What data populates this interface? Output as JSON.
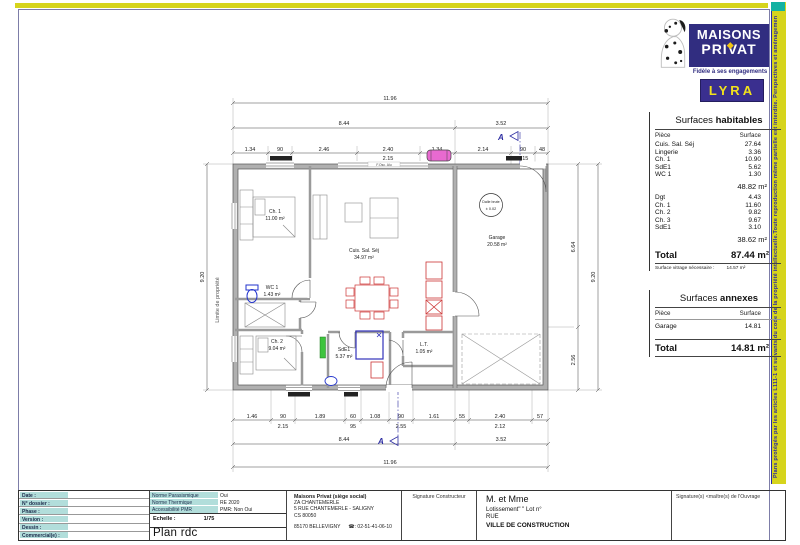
{
  "strips": {
    "copyright_vertical": "Plans protégés par les articles L111-1 et suivants du code de la propriété intellectuelle.Toute reproduction même partielle est interdite. Perspectives et aménagements extérieurs sont non contractuels"
  },
  "logo": {
    "brand_line1": "MAISONS",
    "brand_line2": "PRIVAT",
    "tagline": "Fidèle à ses engagements",
    "model": "LYRA"
  },
  "surfaces_habitables": {
    "title_normal": "Surfaces ",
    "title_bold": "habitables",
    "col_piece": "Pièce",
    "col_surface": "Surface",
    "group1": [
      {
        "n": "Cuis. Sal. Séj",
        "v": "27.64"
      },
      {
        "n": "Lingerie",
        "v": "3.36"
      },
      {
        "n": "Ch. 1",
        "v": "10.90"
      },
      {
        "n": "SdE1",
        "v": "5.62"
      },
      {
        "n": "WC 1",
        "v": "1.30"
      }
    ],
    "group1_subtotal": "48.82 m²",
    "group2": [
      {
        "n": "Dgt",
        "v": "4.43"
      },
      {
        "n": "Ch. 1",
        "v": "11.60"
      },
      {
        "n": "Ch. 2",
        "v": "9.82"
      },
      {
        "n": "Ch. 3",
        "v": "9.67"
      },
      {
        "n": "SdE1",
        "v": "3.10"
      }
    ],
    "group2_subtotal": "38.62 m²",
    "total_label": "Total",
    "total_value": "87.44 m²",
    "vitrage_label": "Surface vitrage nécessaire :",
    "vitrage_value": "14.57 m²"
  },
  "surfaces_annexes": {
    "title_normal": "Surfaces ",
    "title_bold": "annexes",
    "col_piece": "Pièce",
    "col_surface": "Surface",
    "rows": [
      {
        "n": "Garage",
        "v": "14.81"
      }
    ],
    "total_label": "Total",
    "total_value": "14.81 m²"
  },
  "plan": {
    "rooms": {
      "ch1": {
        "name": "Ch. 1",
        "area": "11.00 m²"
      },
      "wc1": {
        "name": "WC 1",
        "area": "1.43 m²"
      },
      "ch2": {
        "name": "Ch. 2",
        "area": "9.04 m²"
      },
      "sde1": {
        "name": "SdE1",
        "area": "5.37 m²"
      },
      "living": {
        "name": "Cuis. Sal. Séj",
        "area": "34.97 m²"
      },
      "lt": {
        "name": "L.T.",
        "area": "1.05 m²"
      },
      "garage": {
        "name": "Garage",
        "area": "20.58 m²"
      }
    },
    "level_marker": {
      "line1": "Dalle brute",
      "line2": "± 0.02"
    },
    "boundary_label": "Limite de propriété",
    "section_marker": "A",
    "window_label": "F.Osc. Alu",
    "dims": {
      "width_total": "11.96",
      "width_main": "8.44",
      "width_garage": "3.52",
      "top_row": [
        "1.34",
        "90",
        "2.46",
        "2.40",
        "1.34",
        "2.14",
        "90",
        "48"
      ],
      "top_row_sub": [
        "1.45",
        "2.15",
        "2.15"
      ],
      "bottom_row": [
        "1.46",
        "90",
        "1.89",
        "60",
        "1.08",
        "90",
        "1.61",
        "55",
        "2.40",
        "57"
      ],
      "bottom_row_sub": [
        "2.15",
        "95",
        "2.55",
        "2.12"
      ],
      "height_total": "9.20",
      "height_garage": "6.64",
      "height_terrace": "2.56",
      "interior": [
        "2.90",
        "4.79",
        "3.10",
        "4.79"
      ]
    }
  },
  "titleblock": {
    "left_fields": [
      "Date :",
      "N° dossier :",
      "Phase :",
      "Version :",
      "Dessin :",
      "Commercial(e) :"
    ],
    "norms": [
      {
        "label": "Norme Parasismique",
        "value": "Oui"
      },
      {
        "label": "Norme Thermique",
        "value": "RE 2020"
      },
      {
        "label": "Accessibilité PMR",
        "value": "PMR: Non Oui"
      }
    ],
    "scale_label": "Echelle :",
    "scale_value": "1/75",
    "plan_name": "Plan rdc",
    "company_name": "Maisons Privat (siège social)",
    "company_addr1": "ZA CHANTEMERLE",
    "company_addr2": "5 RUE CHANTEMERLE - SALIGNY",
    "company_addr3": "CS 80050",
    "company_city": "85170 BELLEVIGNY",
    "company_phone": "☎:  02-51-41-06-10",
    "sig_builder": "Signature Constructeur",
    "client_line1": "M. et Mme",
    "client_line2": "Lotissement\"   \" Lot n°",
    "client_line3": "RUE",
    "client_line4": "VILLE DE CONSTRUCTION",
    "sig_owner": "Signature(s) <maître(s) de l'Ouvrage"
  }
}
